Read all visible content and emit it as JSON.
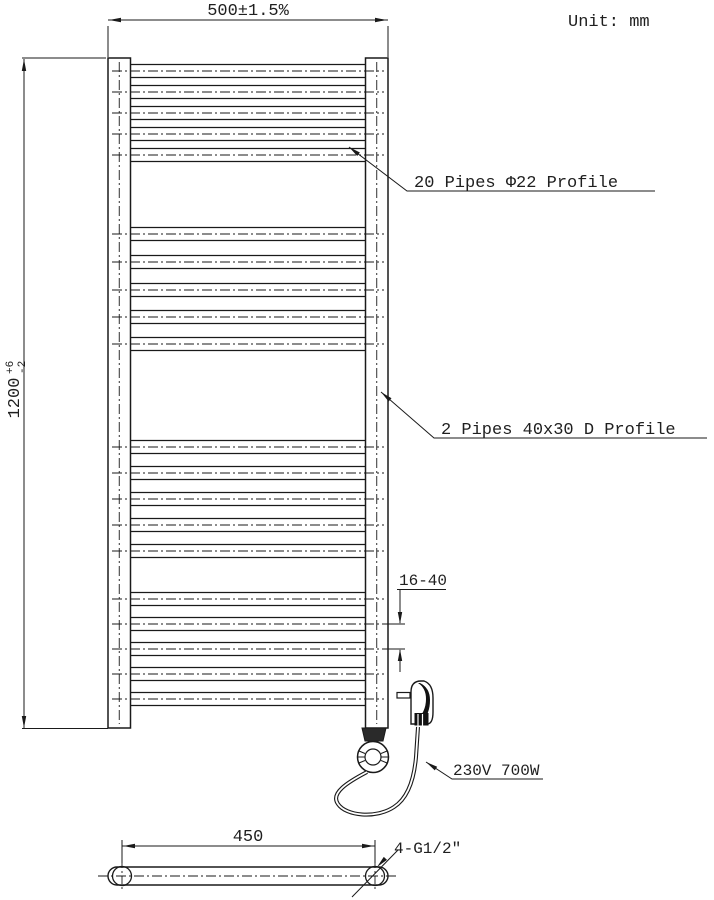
{
  "unit": {
    "label": "Unit: mm"
  },
  "dimensions": {
    "width": "500±1.5%",
    "height_main": "1200",
    "height_sup": "+6",
    "height_sub": "-2",
    "pipe_spacing": "16-40",
    "bottom_width": "450",
    "thread": "4-G1/2″"
  },
  "annotations": {
    "pipes": "20 Pipes  Φ22 Profile",
    "profile": "2 Pipes 40x30 D Profile",
    "power": "230V  700W"
  },
  "drawing": {
    "line_color": "#1a1a1a",
    "pipes": {
      "x1": 130.5,
      "x2": 365.5,
      "cl_x1": 112,
      "cl_x2": 384,
      "half": 6.5,
      "groups": [
        [
          71,
          92,
          113,
          134,
          155
        ],
        [
          234,
          262,
          290,
          317,
          344
        ],
        [
          447,
          473,
          499,
          525,
          551
        ],
        [
          599,
          624,
          649,
          674,
          699
        ]
      ]
    }
  }
}
